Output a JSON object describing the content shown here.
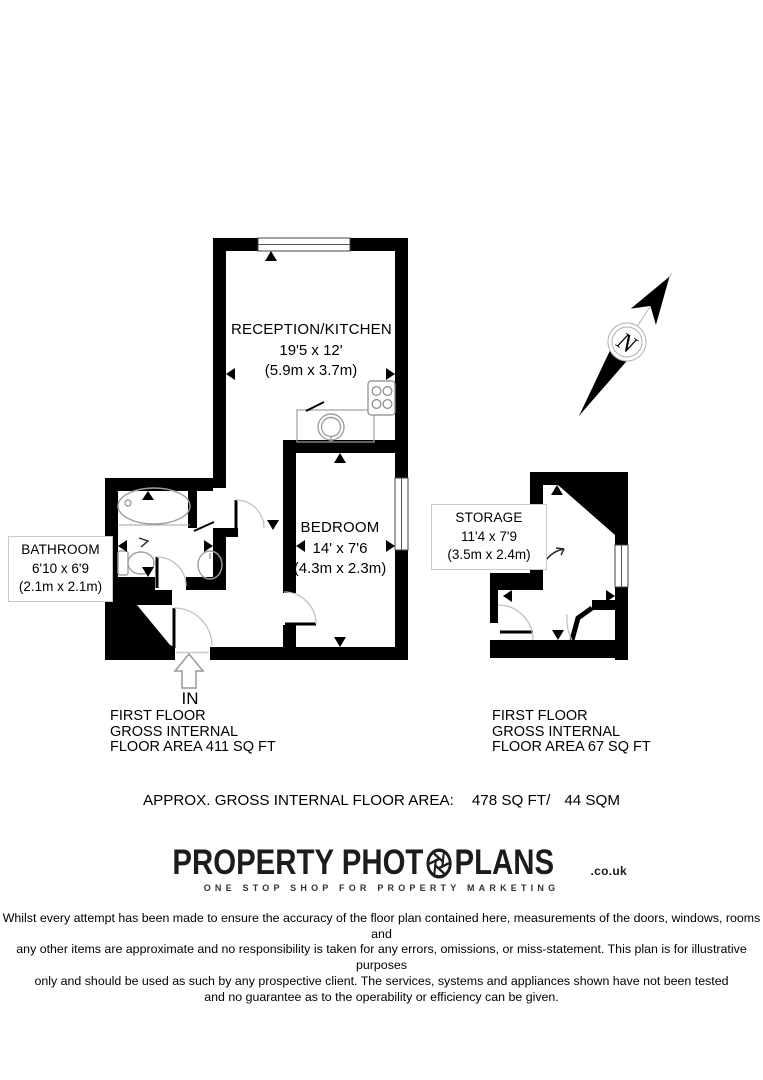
{
  "colors": {
    "walls": "#000000",
    "fixtures": "#a0a0a0",
    "door_arcs": "#c0c0c0",
    "label_box_border": "#c9c9c9",
    "text": "#000000",
    "logo": "#1c1c1c"
  },
  "floorplan": {
    "rooms": [
      {
        "name": "RECEPTION/KITCHEN",
        "dims": "19'5 x 12'",
        "dims_metric": "(5.9m x 3.7m)"
      },
      {
        "name": "BEDROOM",
        "dims": "14' x 7'6",
        "dims_metric": "(4.3m x 2.3m)"
      },
      {
        "name": "BATHROOM",
        "dims": "6'10 x 6'9",
        "dims_metric": "(2.1m x 2.1m)"
      },
      {
        "name": "STORAGE",
        "dims": "11'4 x 7'9",
        "dims_metric": "(3.5m x 2.4m)"
      }
    ],
    "entrance_label": "IN",
    "compass_label": "N"
  },
  "area_summary": {
    "main_unit": {
      "lines": [
        "FIRST FLOOR",
        "GROSS INTERNAL",
        "FLOOR AREA 411 SQ FT"
      ]
    },
    "storage_unit": {
      "lines": [
        "FIRST FLOOR",
        "GROSS INTERNAL",
        "FLOOR AREA 67 SQ FT"
      ]
    },
    "total_label": "APPROX. GROSS INTERNAL FLOOR AREA:",
    "total_sqft": "478 SQ FT/",
    "total_sqm": "44 SQM"
  },
  "branding": {
    "name_left": "PROPERTY PHOT",
    "name_right": "PLANS",
    "domain_suffix": ".co.uk",
    "tagline": "ONE STOP SHOP FOR PROPERTY MARKETING"
  },
  "disclaimer": {
    "lines": [
      "Whilst every attempt has been made to ensure the accuracy of the floor plan contained here, measurements of the doors, windows, rooms and",
      "any other items are approximate and no responsibility is taken for any errors, omissions, or miss-statement. This plan is for illustrative purposes",
      "only and should be used as such by any prospective client. The services, systems and appliances shown have not been tested",
      "and no guarantee as to the operability or efficiency can be given."
    ]
  }
}
